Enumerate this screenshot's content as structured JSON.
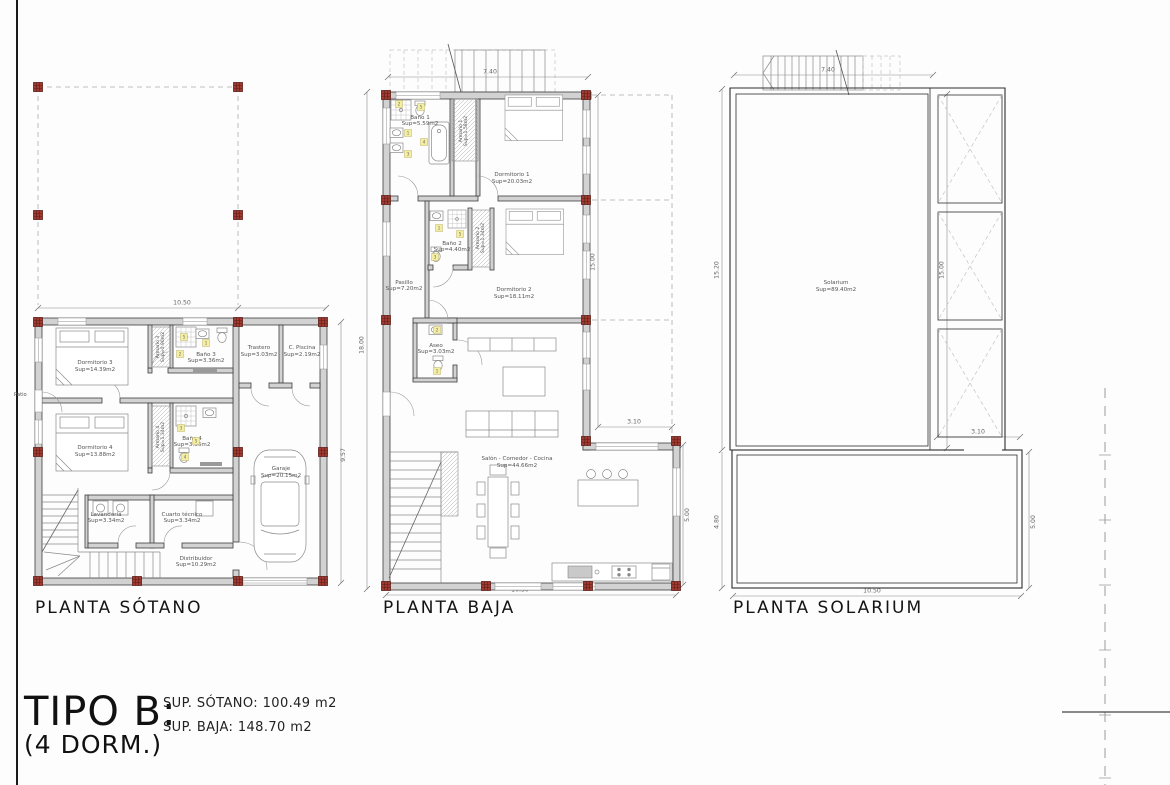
{
  "plans": {
    "sotano": {
      "title": "PLANTA SÓTANO",
      "patio_label": "Patio",
      "rooms": {
        "dormitorio3": {
          "name": "Dormitorio 3",
          "area": "Sup=14.39m2"
        },
        "armario3": {
          "name": "Armario 3",
          "area": "Sup=0.90m2"
        },
        "bano3": {
          "name": "Baño 3",
          "area": "Sup=3.36m2"
        },
        "trastero": {
          "name": "Trastero",
          "area": "Sup=3.03m2"
        },
        "cuarto_piscina": {
          "name": "C. Piscina",
          "area": "Sup=2.19m2"
        },
        "dormitorio4": {
          "name": "Dormitorio 4",
          "area": "Sup=13.88m2"
        },
        "armario4": {
          "name": "Armario 4",
          "area": "Sup=1.34m2"
        },
        "bano4": {
          "name": "Baño 4",
          "area": "Sup=3.36m2"
        },
        "lavanderia": {
          "name": "Lavandería",
          "area": "Sup=3.34m2"
        },
        "cuarto_tecnico": {
          "name": "Cuarto técnico",
          "area": "Sup=3.34m2"
        },
        "distribuidor": {
          "name": "Distribuidor",
          "area": "Sup=10.29m2"
        },
        "garaje": {
          "name": "Garaje",
          "area": "Sup=20.15m2"
        }
      },
      "dims": {
        "width": "10.50",
        "height": "9.57"
      }
    },
    "baja": {
      "title": "PLANTA BAJA",
      "rooms": {
        "bano1": {
          "name": "Baño 1",
          "area": "Sup=5.59m2"
        },
        "armario1": {
          "name": "Armario 1",
          "area": "Sup=1.58m2"
        },
        "dormitorio1": {
          "name": "Dormitorio 1",
          "area": "Sup=20.03m2"
        },
        "bano2": {
          "name": "Baño 2",
          "area": "Sup=4.40m2"
        },
        "armario2": {
          "name": "Armario 2",
          "area": "Sup=1.34m2"
        },
        "dormitorio2": {
          "name": "Dormitorio 2",
          "area": "Sup=18.11m2"
        },
        "pasillo": {
          "name": "Pasillo",
          "area": "Sup=7.20m2"
        },
        "aseo": {
          "name": "Aseo",
          "area": "Sup=3.03m2"
        },
        "salon": {
          "name": "Salón - Comedor - Cocina",
          "area": "Sup=44.66m2"
        }
      },
      "dims": {
        "stair_width": "7.40",
        "left_height": "18.00",
        "right_height": "15.00",
        "terrace_width": "3.10",
        "terrace_height": "5.00",
        "bottom_width": "10.30"
      }
    },
    "solarium": {
      "title": "PLANTA SOLARIUM",
      "rooms": {
        "solarium": {
          "name": "Solarium",
          "area": "Sup=89.40m2"
        }
      },
      "dims": {
        "stair_width": "7.40",
        "left_upper_height": "15.20",
        "inner_height": "15.00",
        "opening_width": "3.10",
        "left_lower_height": "4.80",
        "right_lower_height": "5.00",
        "bottom_width": "10.50"
      }
    }
  },
  "title_block": {
    "title": "TIPO B:",
    "subtitle": "(4 DORM.)",
    "sup_sotano": "SUP. SÓTANO: 100.49 m2",
    "sup_baja": "SUP. BAJA: 148.70 m2"
  },
  "markers": {
    "yellow": [
      {
        "x": 184,
        "y": 337,
        "n": "5"
      },
      {
        "x": 206,
        "y": 343,
        "n": "1"
      },
      {
        "x": 180,
        "y": 354,
        "n": "2"
      },
      {
        "x": 181,
        "y": 428,
        "n": "3"
      },
      {
        "x": 196,
        "y": 441,
        "n": "5"
      },
      {
        "x": 185,
        "y": 457,
        "n": "4"
      },
      {
        "x": 399,
        "y": 104,
        "n": "2"
      },
      {
        "x": 421,
        "y": 107,
        "n": "5"
      },
      {
        "x": 408,
        "y": 133,
        "n": "1"
      },
      {
        "x": 424,
        "y": 142,
        "n": "4"
      },
      {
        "x": 408,
        "y": 154,
        "n": "3"
      },
      {
        "x": 439,
        "y": 228,
        "n": "1"
      },
      {
        "x": 460,
        "y": 234,
        "n": "5"
      },
      {
        "x": 435,
        "y": 257,
        "n": "3"
      },
      {
        "x": 437,
        "y": 330,
        "n": "2"
      },
      {
        "x": 437,
        "y": 371,
        "n": "1"
      }
    ]
  },
  "colors": {
    "wall_fill": "#d2d2d2",
    "line": "#8a8a8a",
    "column_marker": "#a03a30",
    "fixture_key": "#f4eea2",
    "text": "#555555"
  }
}
